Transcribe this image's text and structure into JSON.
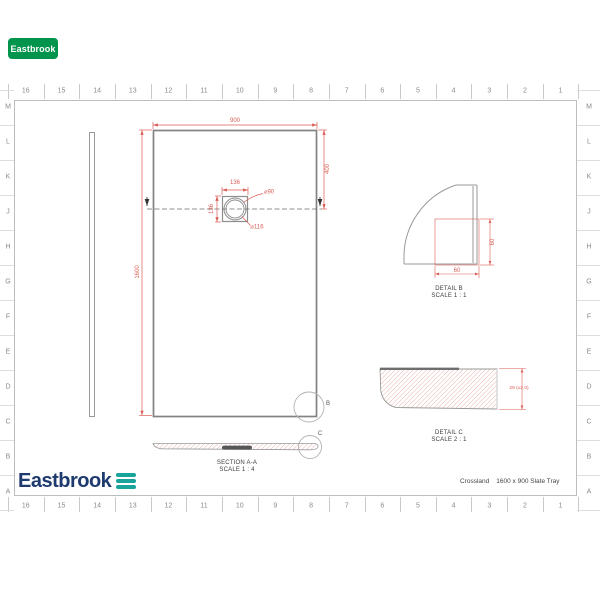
{
  "badge": {
    "label": "Eastbrook",
    "color": "#00944d"
  },
  "ruler": {
    "numbers": [
      "16",
      "15",
      "14",
      "13",
      "12",
      "11",
      "10",
      "9",
      "8",
      "7",
      "6",
      "5",
      "4",
      "3",
      "2",
      "1"
    ],
    "letters": [
      "M",
      "L",
      "K",
      "J",
      "H",
      "G",
      "F",
      "E",
      "D",
      "C",
      "B",
      "A"
    ]
  },
  "plan": {
    "dim_width": "900",
    "dim_to_centre": "400",
    "dim_length": "1600",
    "drain_dim_x": "136",
    "drain_dim_y": "136",
    "waste_dia": "⌀90",
    "cover_dia": "⌀116",
    "corner_callout": "B"
  },
  "section": {
    "label": "SECTION A-A",
    "scale": "SCALE 1 : 4",
    "end_callout": "C"
  },
  "detail_b": {
    "label": "DETAIL B",
    "scale": "SCALE 1 : 1",
    "dim_vertical": "60",
    "dim_horizontal": "60"
  },
  "detail_c": {
    "label": "DETAIL C",
    "scale": "SCALE 2 : 1",
    "dim_thickness": "28 (±2.0)"
  },
  "footer": {
    "logo_text": "Eastbrook",
    "product_name": "Crossland",
    "product_desc": "1600 x 900 Slate Tray"
  },
  "colors": {
    "dimension_red": "#d95f57",
    "line_gray": "#8d8d8d",
    "logo_navy": "#1e3a6e",
    "logo_teal": "#18a39b",
    "badge_green": "#00944d"
  }
}
